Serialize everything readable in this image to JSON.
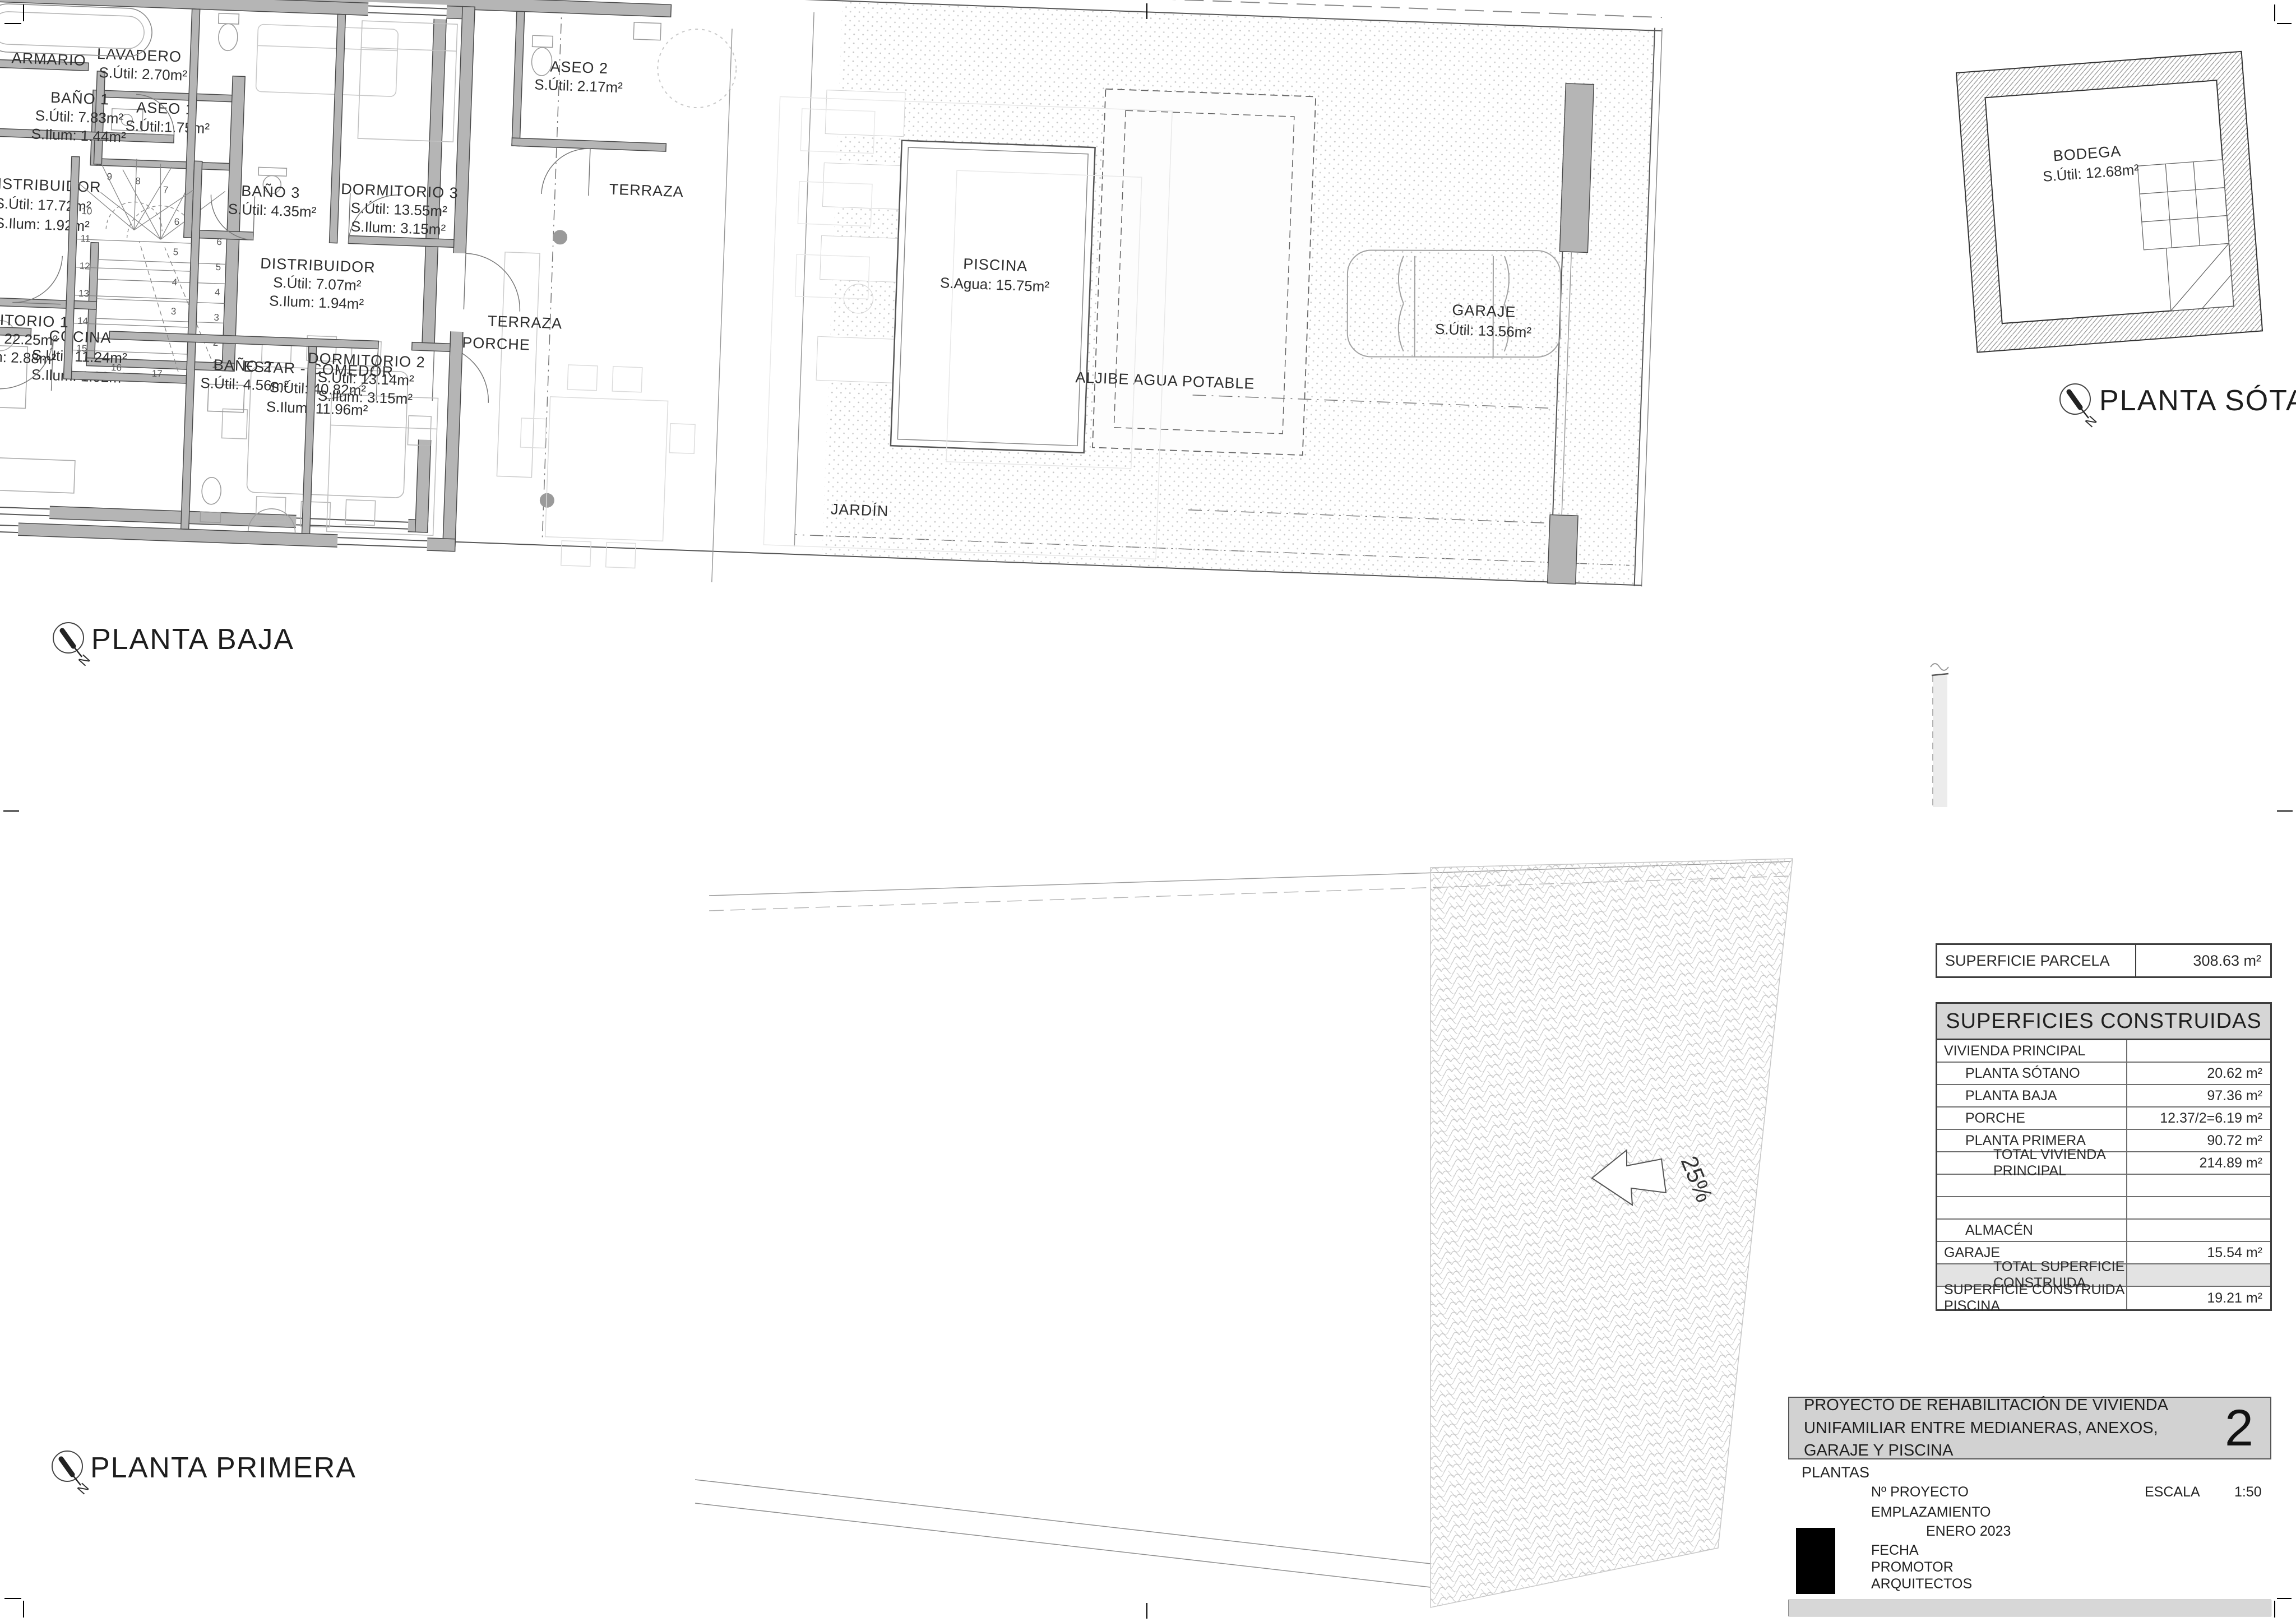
{
  "sheet": {
    "number": "2",
    "title_line": "PROYECTO DE REHABILITACIÓN DE VIVIENDA UNIFAMILIAR ENTRE MEDIANERAS, ANEXOS, GARAJE Y PISCINA",
    "content_label": "PLANTAS",
    "fields": [
      "Nº PROYECTO",
      "EMPLAZAMIENTO",
      "FECHA",
      "PROMOTOR",
      "ARQUITECTOS"
    ],
    "date_value": "ENERO 2023",
    "scale_label": "ESCALA",
    "scale_value": "1:50"
  },
  "compass": {
    "n": "N"
  },
  "plans": {
    "pb": {
      "title": "PLANTA BAJA",
      "armario": {
        "n": "ARMARIO"
      },
      "lavadero": {
        "n": "LAVADERO",
        "u": "S.Útil: 2.70m²"
      },
      "aseo1": {
        "n": "ASEO 1",
        "u": "S.Útil:1.75m²"
      },
      "distribuidor": {
        "n": "DISTRIBUIDOR",
        "u": "S.Útil: 17.72m²",
        "i": "S.Ilum: 1.92m²"
      },
      "cocina": {
        "n": "COCINA",
        "u": "S.Útil: 11.24m²",
        "i": "S.Ilum: 1.92m²"
      },
      "estar": {
        "n": "ESTAR - COMEDOR",
        "u": "S.Útil: 40.82m²",
        "i": "S.Ilum: 11.96m²"
      },
      "aseo2": {
        "n": "ASEO 2",
        "u": "S.Útil: 2.17m²"
      },
      "terraza": {
        "n": "TERRAZA"
      },
      "porche": {
        "n": "PORCHE"
      },
      "piscina": {
        "n": "PISCINA",
        "u": "S.Agua: 15.75m²"
      },
      "aljibe": {
        "n": "ALJIBE AGUA POTABLE"
      },
      "jardin": {
        "n": "JARDÍN"
      },
      "garaje": {
        "n": "GARAJE",
        "u": "S.Útil: 13.56m²"
      }
    },
    "ps": {
      "title": "PLANTA SÓTANO",
      "bodega": {
        "n": "BODEGA",
        "u": "S.Útil: 12.68m²"
      }
    },
    "pp": {
      "title": "PLANTA PRIMERA",
      "ramp": "25%",
      "bano1": {
        "n": "BAÑO 1",
        "u": "S.Útil: 7.83m²",
        "i": "S.Ilum: 1.44m²"
      },
      "bano3": {
        "n": "BAÑO 3",
        "u": "S.Útil: 4.35m²"
      },
      "dorm3": {
        "n": "DORMITORIO 3",
        "u": "S.Útil: 13.55m²",
        "i": "S.Ilum: 3.15m²"
      },
      "distribuidor": {
        "n": "DISTRIBUIDOR",
        "u": "S.Útil: 7.07m²",
        "i": "S.Ilum: 1.94m²"
      },
      "dorm1": {
        "n": "DORMITORIO 1",
        "u": "S.Útil: 22.25m²",
        "i": "S.Ilum: 2.88m²"
      },
      "bano2": {
        "n": "BAÑO 2",
        "u": "S.Útil: 4.56m²"
      },
      "dorm2": {
        "n": "DORMITORIO 2",
        "u": "S.Útil: 13.14m²",
        "i": "S.Ilum: 3.15m²"
      },
      "terraza": {
        "n": "TERRAZA"
      }
    }
  },
  "stairs": {
    "pb": [
      "6",
      "5",
      "4",
      "3",
      "2",
      "1"
    ],
    "pp_top": [
      "9",
      "8",
      "7"
    ],
    "pp_right": [
      "6",
      "5",
      "4",
      "3"
    ],
    "pp_left": [
      "10",
      "11",
      "12",
      "13",
      "14",
      "15"
    ],
    "pp_bottom": [
      "16",
      "17"
    ]
  },
  "tables": {
    "parcela": {
      "label": "SUPERFICIE PARCELA",
      "value": "308.63 m²"
    },
    "construidas": {
      "title": "SUPERFICIES CONSTRUIDAS",
      "rows": [
        {
          "l": "VIVIENDA PRINCIPAL",
          "v": ""
        },
        {
          "l": "PLANTA SÓTANO",
          "v": "20.62 m²"
        },
        {
          "l": "PLANTA BAJA",
          "v": "97.36 m²"
        },
        {
          "l": "PORCHE",
          "v": "12.37/2=6.19 m²"
        },
        {
          "l": "PLANTA PRIMERA",
          "v": "90.72 m²"
        },
        {
          "l": "TOTAL  VIVIENDA PRINCIPAL",
          "v": "214.89 m²"
        },
        {
          "l": "",
          "v": ""
        },
        {
          "l": "",
          "v": ""
        },
        {
          "l": "ALMACÉN",
          "v": ""
        },
        {
          "l": "GARAJE",
          "v": "15.54 m²"
        },
        {
          "l": "TOTAL  SUPERFICIE CONSTRUIDA",
          "v": ""
        },
        {
          "l": "SUPERFICIE CONSTRUIDA PISCINA",
          "v": "19.21 m²"
        }
      ]
    }
  }
}
